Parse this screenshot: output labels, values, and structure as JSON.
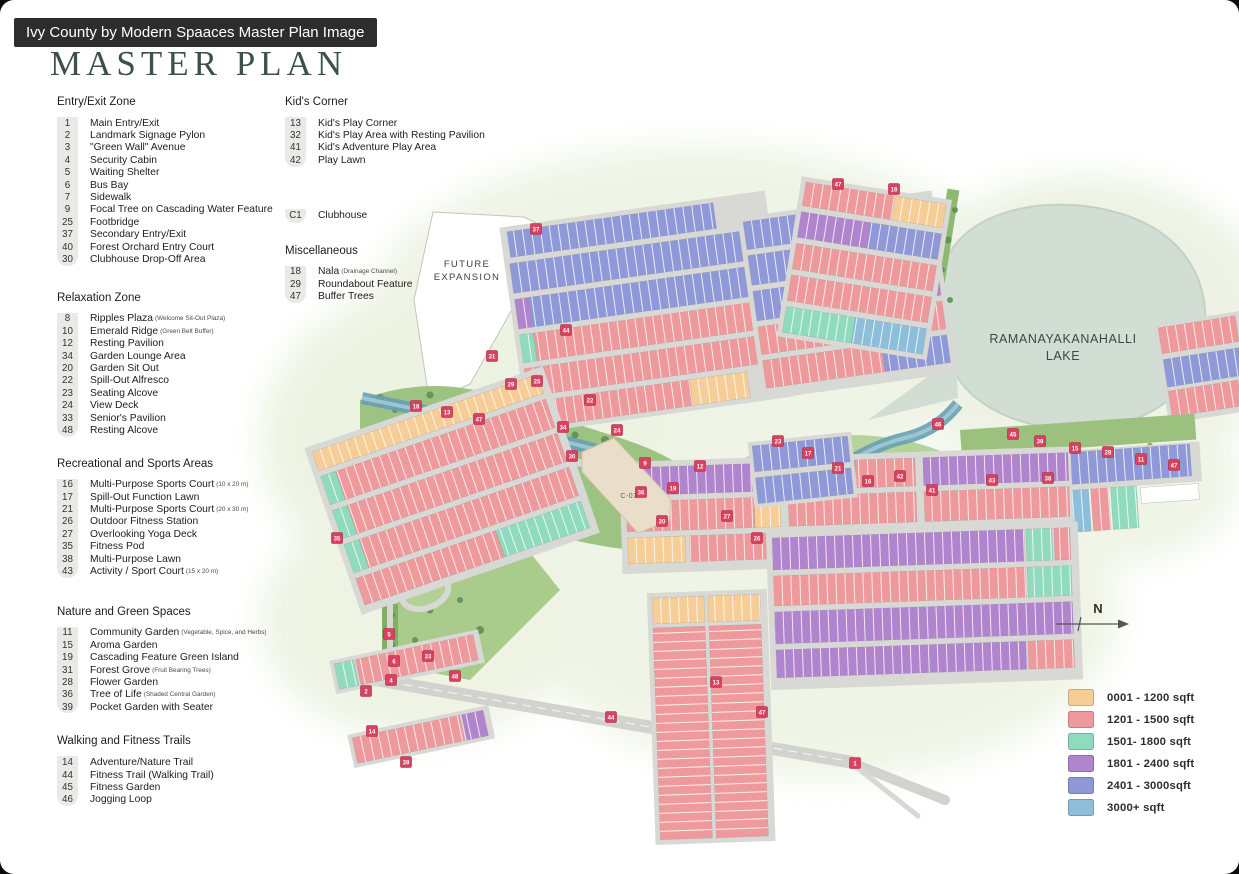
{
  "page": {
    "banner": "Ivy County by Modern Spaaces Master Plan Image",
    "title": "MASTER PLAN"
  },
  "legend": {
    "entry_exit": {
      "title": "Entry/Exit Zone",
      "items": [
        {
          "n": "1",
          "label": "Main Entry/Exit"
        },
        {
          "n": "2",
          "label": "Landmark Signage Pylon"
        },
        {
          "n": "3",
          "label": "\"Green Wall\" Avenue"
        },
        {
          "n": "4",
          "label": "Security Cabin"
        },
        {
          "n": "5",
          "label": "Waiting Shelter"
        },
        {
          "n": "6",
          "label": "Bus Bay"
        },
        {
          "n": "7",
          "label": "Sidewalk"
        },
        {
          "n": "9",
          "label": "Focal Tree on Cascading Water Feature"
        },
        {
          "n": "25",
          "label": "Footbridge"
        },
        {
          "n": "37",
          "label": "Secondary Entry/Exit"
        },
        {
          "n": "40",
          "label": "Forest Orchard Entry Court"
        },
        {
          "n": "30",
          "label": "Clubhouse Drop-Off Area"
        }
      ]
    },
    "relaxation": {
      "title": "Relaxation Zone",
      "items": [
        {
          "n": "8",
          "label": "Ripples Plaza",
          "note": "(Welcome Sit-Out Plaza)"
        },
        {
          "n": "10",
          "label": "Emerald Ridge",
          "note": "(Green Belt Buffer)"
        },
        {
          "n": "12",
          "label": "Resting Pavilion"
        },
        {
          "n": "34",
          "label": "Garden Lounge Area"
        },
        {
          "n": "20",
          "label": "Garden Sit Out"
        },
        {
          "n": "22",
          "label": "Spill-Out Alfresco"
        },
        {
          "n": "23",
          "label": "Seating Alcove"
        },
        {
          "n": "24",
          "label": "View Deck"
        },
        {
          "n": "33",
          "label": "Senior's Pavilion"
        },
        {
          "n": "48",
          "label": "Resting Alcove"
        }
      ]
    },
    "sports": {
      "title": "Recreational and Sports Areas",
      "items": [
        {
          "n": "16",
          "label": "Multi-Purpose Sports Court",
          "note": "(10 x 20 m)"
        },
        {
          "n": "17",
          "label": "Spill-Out Function Lawn"
        },
        {
          "n": "21",
          "label": "Multi-Purpose Sports Court",
          "note": "(20 x 30 m)"
        },
        {
          "n": "26",
          "label": "Outdoor Fitness Station"
        },
        {
          "n": "27",
          "label": "Overlooking Yoga Deck"
        },
        {
          "n": "35",
          "label": "Fitness Pod"
        },
        {
          "n": "38",
          "label": "Multi-Purpose Lawn"
        },
        {
          "n": "43",
          "label": "Activity / Sport Court",
          "note": "(15 x 20 m)"
        }
      ]
    },
    "nature": {
      "title": "Nature and Green Spaces",
      "items": [
        {
          "n": "11",
          "label": "Community Garden",
          "note": "(Vegetable, Spice, and Herbs)"
        },
        {
          "n": "15",
          "label": "Aroma Garden"
        },
        {
          "n": "19",
          "label": "Cascading Feature Green Island"
        },
        {
          "n": "31",
          "label": "Forest Grove",
          "note": "(Fruit Bearing Trees)"
        },
        {
          "n": "28",
          "label": "Flower Garden"
        },
        {
          "n": "36",
          "label": "Tree of Life",
          "note": "(Shaded Central Garden)"
        },
        {
          "n": "39",
          "label": "Pocket Garden with Seater"
        }
      ]
    },
    "walking": {
      "title": "Walking and Fitness Trails",
      "items": [
        {
          "n": "14",
          "label": "Adventure/Nature Trail"
        },
        {
          "n": "44",
          "label": "Fitness Trail (Walking Trail)"
        },
        {
          "n": "45",
          "label": "Fitness Garden"
        },
        {
          "n": "46",
          "label": "Jogging Loop"
        }
      ]
    },
    "kids": {
      "title": "Kid's Corner",
      "items": [
        {
          "n": "13",
          "label": "Kid's Play Corner"
        },
        {
          "n": "32",
          "label": "Kid's Play Area with Resting Pavilion"
        },
        {
          "n": "41",
          "label": "Kid's Adventure Play Area"
        },
        {
          "n": "42",
          "label": "Play Lawn"
        }
      ]
    },
    "clubhouse": {
      "n": "C1",
      "label": "Clubhouse"
    },
    "misc": {
      "title": "Miscellaneous",
      "items": [
        {
          "n": "18",
          "label": "Nala",
          "note": "(Drainage Channel)"
        },
        {
          "n": "29",
          "label": "Roundabout Feature"
        },
        {
          "n": "47",
          "label": "Buffer Trees"
        }
      ]
    }
  },
  "size_legend": {
    "items": [
      {
        "color": "#F7CD96",
        "label": "0001 - 1200 sqft"
      },
      {
        "color": "#EE9A9C",
        "label": "1201 - 1500 sqft"
      },
      {
        "color": "#90DABD",
        "label": "1501- 1800 sqft"
      },
      {
        "color": "#B184CE",
        "label": "1801 - 2400 sqft"
      },
      {
        "color": "#8F99D8",
        "label": "2401 - 3000sqft"
      },
      {
        "color": "#8DBFDA",
        "label": "3000+ sqft"
      }
    ]
  },
  "map": {
    "future_expansion": [
      "FUTURE",
      "EXPANSION"
    ],
    "lake_name": [
      "RAMANAYAKANAHALLI",
      "LAKE"
    ],
    "north": "N",
    "clubhouse_mark": "C-01",
    "marker_color": "#d8415f",
    "markers": [
      {
        "n": "37",
        "x": 536,
        "y": 229
      },
      {
        "n": "47",
        "x": 838,
        "y": 184
      },
      {
        "n": "18",
        "x": 894,
        "y": 189
      },
      {
        "n": "44",
        "x": 566,
        "y": 330
      },
      {
        "n": "31",
        "x": 492,
        "y": 356
      },
      {
        "n": "18",
        "x": 416,
        "y": 406
      },
      {
        "n": "13",
        "x": 447,
        "y": 412
      },
      {
        "n": "47",
        "x": 479,
        "y": 419
      },
      {
        "n": "29",
        "x": 511,
        "y": 384
      },
      {
        "n": "25",
        "x": 537,
        "y": 381
      },
      {
        "n": "34",
        "x": 563,
        "y": 427
      },
      {
        "n": "22",
        "x": 590,
        "y": 400
      },
      {
        "n": "24",
        "x": 617,
        "y": 430
      },
      {
        "n": "9",
        "x": 645,
        "y": 463
      },
      {
        "n": "19",
        "x": 673,
        "y": 488
      },
      {
        "n": "12",
        "x": 700,
        "y": 466
      },
      {
        "n": "27",
        "x": 727,
        "y": 516
      },
      {
        "n": "26",
        "x": 757,
        "y": 538
      },
      {
        "n": "23",
        "x": 778,
        "y": 441
      },
      {
        "n": "17",
        "x": 808,
        "y": 453
      },
      {
        "n": "21",
        "x": 838,
        "y": 468
      },
      {
        "n": "16",
        "x": 868,
        "y": 481
      },
      {
        "n": "42",
        "x": 900,
        "y": 476
      },
      {
        "n": "41",
        "x": 932,
        "y": 490
      },
      {
        "n": "30",
        "x": 572,
        "y": 456
      },
      {
        "n": "36",
        "x": 641,
        "y": 492
      },
      {
        "n": "20",
        "x": 662,
        "y": 521
      },
      {
        "n": "45",
        "x": 1013,
        "y": 434
      },
      {
        "n": "39",
        "x": 1040,
        "y": 441
      },
      {
        "n": "15",
        "x": 1075,
        "y": 448
      },
      {
        "n": "28",
        "x": 1108,
        "y": 452
      },
      {
        "n": "11",
        "x": 1141,
        "y": 459
      },
      {
        "n": "47",
        "x": 1174,
        "y": 465
      },
      {
        "n": "43",
        "x": 992,
        "y": 480
      },
      {
        "n": "38",
        "x": 1048,
        "y": 478
      },
      {
        "n": "35",
        "x": 337,
        "y": 538
      },
      {
        "n": "5",
        "x": 389,
        "y": 634
      },
      {
        "n": "6",
        "x": 394,
        "y": 661
      },
      {
        "n": "4",
        "x": 391,
        "y": 680
      },
      {
        "n": "2",
        "x": 366,
        "y": 691
      },
      {
        "n": "14",
        "x": 372,
        "y": 731
      },
      {
        "n": "39",
        "x": 406,
        "y": 762
      },
      {
        "n": "33",
        "x": 428,
        "y": 656
      },
      {
        "n": "48",
        "x": 455,
        "y": 676
      },
      {
        "n": "44",
        "x": 611,
        "y": 717
      },
      {
        "n": "13",
        "x": 716,
        "y": 682
      },
      {
        "n": "47",
        "x": 762,
        "y": 712
      },
      {
        "n": "1",
        "x": 855,
        "y": 763
      },
      {
        "n": "46",
        "x": 938,
        "y": 424
      }
    ]
  }
}
